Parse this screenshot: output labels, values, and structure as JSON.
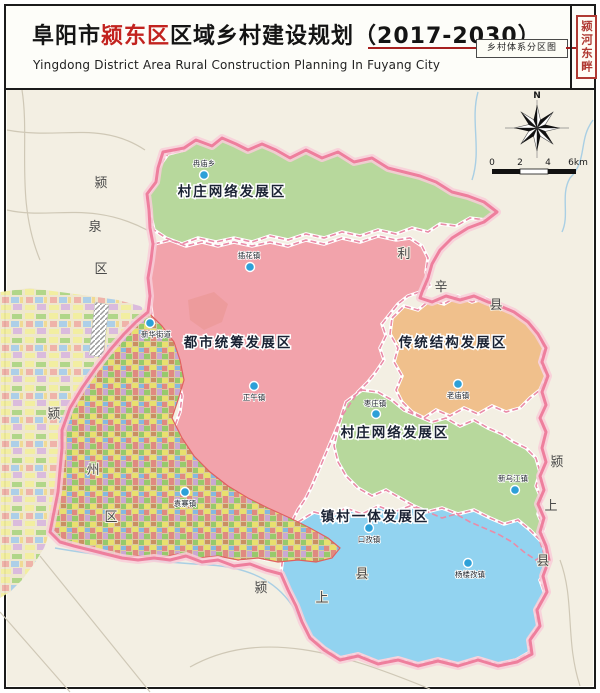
{
  "header": {
    "title_prefix": "阜阳市",
    "title_highlight": "颍东区",
    "title_suffix": "区域乡村建设规划（2017-2030）",
    "subtitle": "Yingdong District Area Rural Construction Planning In Fuyang City",
    "map_type_label": "乡村体系分区图",
    "seal_text": "颍河东畔"
  },
  "map": {
    "compass_label": "N",
    "scale_labels": [
      "0",
      "2",
      "4",
      "6km"
    ],
    "regions": [
      {
        "name": "村庄网络发展区"
      },
      {
        "name": "都市统筹发展区"
      },
      {
        "name": "传统结构发展区"
      },
      {
        "name": "村庄网络发展区"
      },
      {
        "name": "镇村一体发展区"
      }
    ],
    "towns": [
      {
        "name": "冉庙乡"
      },
      {
        "name": "插花镇"
      },
      {
        "name": "新华街道"
      },
      {
        "name": "正午镇"
      },
      {
        "name": "老庙镇"
      },
      {
        "name": "枣庄镇"
      },
      {
        "name": "新乌江镇"
      },
      {
        "name": "口孜镇"
      },
      {
        "name": "杨楼孜镇"
      },
      {
        "name": "袁寨镇"
      }
    ],
    "neighbors": [
      {
        "name": "颍泉区",
        "chars": [
          "颍",
          "泉",
          "区"
        ]
      },
      {
        "name": "利辛县",
        "chars": [
          "利",
          "辛",
          "县"
        ]
      },
      {
        "name": "颍上县",
        "chars": [
          "颍",
          "上",
          "县"
        ]
      },
      {
        "name": "颍上县",
        "chars": [
          "颍",
          "上",
          "县"
        ]
      },
      {
        "name": "颍州区",
        "chars": [
          "颍",
          "州",
          "区"
        ]
      }
    ]
  },
  "colors": {
    "title_highlight": "#c2231f",
    "accent_red": "#a6201f",
    "seal_red": "#b03a33",
    "map_bg": "#f3efe3",
    "region_green": "#b7d89c",
    "region_pink": "#f2a3ab",
    "region_orange": "#f0c08c",
    "region_blue": "#92d3f0",
    "boundary_pink": "#ee7f9d",
    "boundary_halo": "#f8ccd8",
    "town_dot": "#2da0d8",
    "water": "#a9cfe4"
  }
}
